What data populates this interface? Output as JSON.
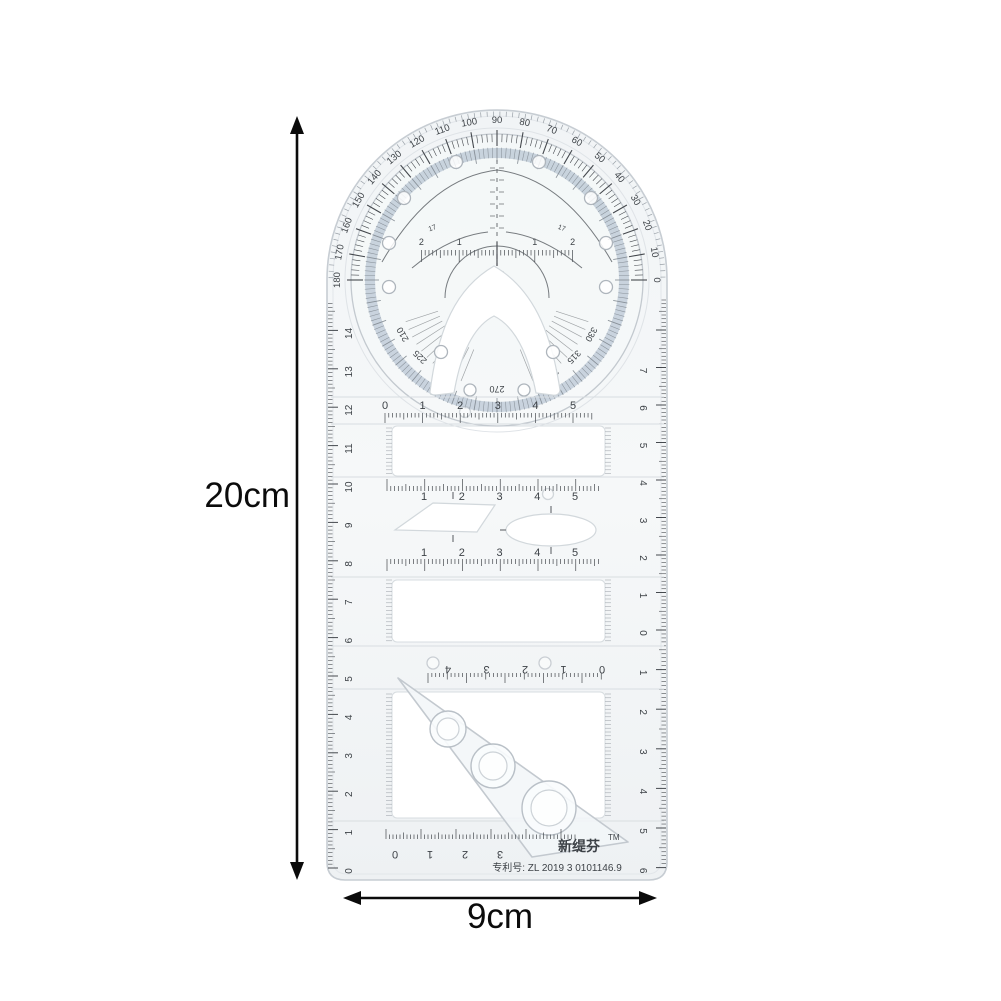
{
  "annotations": {
    "height": "20cm",
    "width": "9cm"
  },
  "branding": {
    "name": "新缇芬",
    "tm": "TM",
    "patent": "专利号: ZL 2019 3 0101146.9"
  },
  "protractor": {
    "degree_labels": [
      "0",
      "10",
      "20",
      "30",
      "40",
      "50",
      "60",
      "70",
      "80",
      "90",
      "100",
      "110",
      "120",
      "130",
      "140",
      "150",
      "160",
      "170",
      "180"
    ],
    "disc_labels": [
      "210",
      "225",
      "240",
      "270",
      "300",
      "315",
      "330"
    ],
    "disc_arc_labels": [
      "17",
      "17"
    ],
    "center_ruler_labels": [
      "2",
      "1",
      "1",
      "2"
    ]
  },
  "scales": {
    "left_edge": [
      "0",
      "1",
      "2",
      "3",
      "4",
      "5",
      "6",
      "7",
      "8",
      "9",
      "10",
      "11",
      "12",
      "13",
      "14"
    ],
    "right_edge_up": [
      "0",
      "1",
      "2",
      "3",
      "4",
      "5",
      "6",
      "7"
    ],
    "right_edge_down": [
      "1",
      "2",
      "3",
      "4",
      "5",
      "6"
    ],
    "top_bar": [
      "0",
      "1",
      "2",
      "3",
      "4",
      "5"
    ],
    "mid_bar_top": [
      "1",
      "2",
      "3",
      "4",
      "5"
    ],
    "mid_bar_bottom": [
      "1",
      "2",
      "3",
      "4",
      "5"
    ],
    "lower_bar": [
      "0",
      "1",
      "2",
      "3",
      "4"
    ],
    "bottom_bar": [
      "0",
      "1",
      "2",
      "3"
    ]
  },
  "colors": {
    "plastic_edge": "#c7cdd3",
    "plastic_fill": "#f3f5f7",
    "marking": "#45494e",
    "blue_band": "#b9c7d4",
    "annotation": "#0b0b0b"
  }
}
